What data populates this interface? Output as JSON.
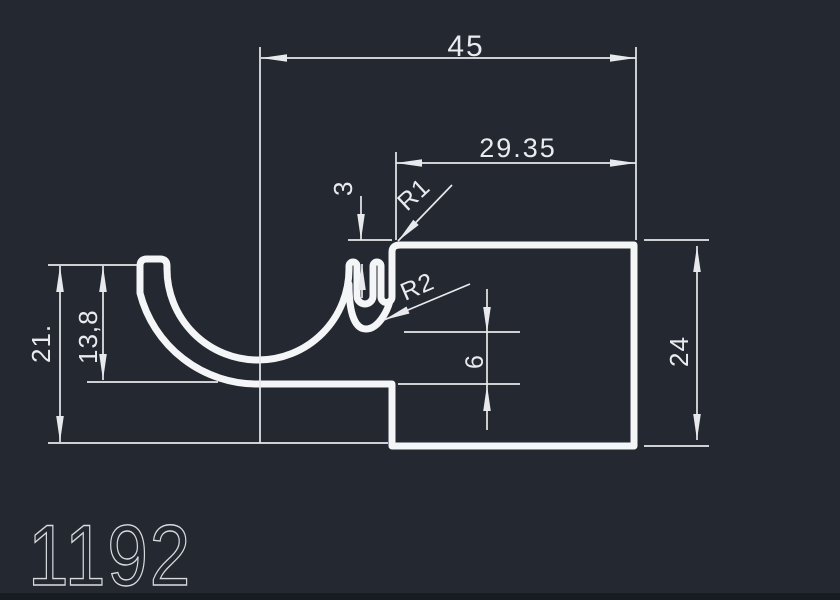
{
  "app": {
    "background_color": "#232831",
    "line_color": "#f4f5f6",
    "dim_line_color": "#e7e9ec",
    "text_color": "#e9ebee"
  },
  "drawing": {
    "part_number": "1192",
    "dimensions": {
      "total_width": "45",
      "right_width": "29.35",
      "wall_thickness": "3",
      "fillet_radius_1": "R1",
      "fillet_radius_2": "R2",
      "left_height": "21.",
      "channel_height": "13,8",
      "hook_gap": "6",
      "right_height": "24"
    }
  }
}
